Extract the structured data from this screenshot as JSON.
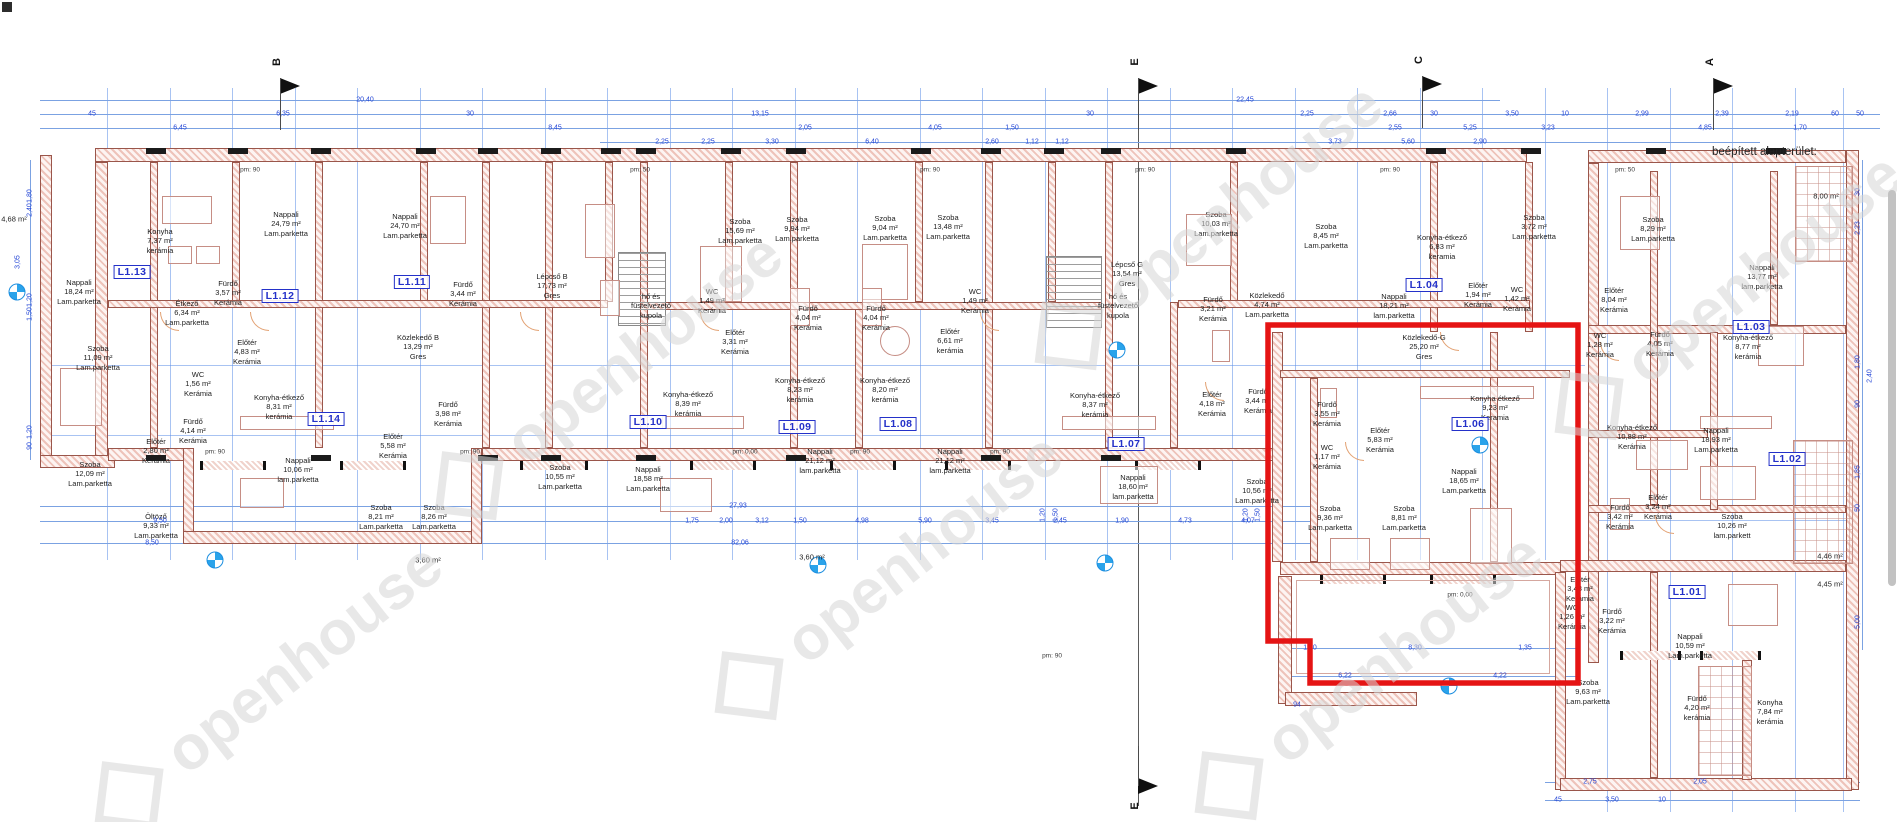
{
  "meta": {
    "area_note": "beépített alapterület:"
  },
  "watermark": {
    "text": "openhouse"
  },
  "highlight": {
    "color": "#e51414"
  },
  "colors": {
    "dim_blue": "#2446d6",
    "unit_blue": "#2431c9",
    "wall_hatch": "#9a564b"
  },
  "section_markers": [
    {
      "label": "B",
      "x": 280,
      "y": 72,
      "dir": "down"
    },
    {
      "label": "E",
      "x": 1138,
      "y": 72,
      "dir": "down"
    },
    {
      "label": "C",
      "x": 1422,
      "y": 70,
      "dir": "down"
    },
    {
      "label": "A",
      "x": 1713,
      "y": 72,
      "dir": "down"
    },
    {
      "label": "E",
      "x": 1138,
      "y": 786,
      "dir": "up"
    }
  ],
  "units": [
    {
      "t": "L1.13",
      "x": 132,
      "y": 272
    },
    {
      "t": "L1.12",
      "x": 280,
      "y": 296
    },
    {
      "t": "L1.11",
      "x": 412,
      "y": 282
    },
    {
      "t": "L1.14",
      "x": 326,
      "y": 419
    },
    {
      "t": "L1.10",
      "x": 648,
      "y": 422
    },
    {
      "t": "L1.09",
      "x": 797,
      "y": 427
    },
    {
      "t": "L1.08",
      "x": 898,
      "y": 424
    },
    {
      "t": "L1.07",
      "x": 1126,
      "y": 444
    },
    {
      "t": "L1.06",
      "x": 1470,
      "y": 424
    },
    {
      "t": "L1.04",
      "x": 1424,
      "y": 285
    },
    {
      "t": "L1.03",
      "x": 1751,
      "y": 327
    },
    {
      "t": "L1.02",
      "x": 1787,
      "y": 459
    },
    {
      "t": "L1.01",
      "x": 1687,
      "y": 592
    }
  ],
  "rooms": [
    {
      "l": [
        "Nappali",
        "18,24 m²",
        "Lam.parketta"
      ],
      "x": 79,
      "y": 292
    },
    {
      "l": [
        "Konyha",
        "7,37 m²",
        "kerámia"
      ],
      "x": 160,
      "y": 241
    },
    {
      "l": [
        "Nappali",
        "24,79 m²",
        "Lam.parketta"
      ],
      "x": 286,
      "y": 224
    },
    {
      "l": [
        "Fürdő",
        "3,57 m²",
        "Kerámia"
      ],
      "x": 228,
      "y": 293
    },
    {
      "l": [
        "Nappali",
        "24,70 m²",
        "Lam.parketta"
      ],
      "x": 405,
      "y": 226
    },
    {
      "l": [
        "Fürdő",
        "3,44 m²",
        "Kerámia"
      ],
      "x": 463,
      "y": 294
    },
    {
      "l": [
        "Szoba",
        "11,09 m²",
        "Lam.parketta"
      ],
      "x": 98,
      "y": 358
    },
    {
      "l": [
        "Étkező",
        "6,34 m²",
        "Lam.parketta"
      ],
      "x": 187,
      "y": 313
    },
    {
      "l": [
        "Előtér",
        "4,83 m²",
        "Kerámia"
      ],
      "x": 247,
      "y": 352
    },
    {
      "l": [
        "WC",
        "1,56 m²",
        "Kerámia"
      ],
      "x": 198,
      "y": 384
    },
    {
      "l": [
        "Fürdő",
        "4,14 m²",
        "Kerámia"
      ],
      "x": 193,
      "y": 431
    },
    {
      "l": [
        "Előtér",
        "2,80 m²",
        "Kerámia"
      ],
      "x": 156,
      "y": 451
    },
    {
      "l": [
        "Szoba",
        "12,09 m²",
        "Lam.parketta"
      ],
      "x": 90,
      "y": 474
    },
    {
      "l": [
        "Öltöző",
        "9,33 m²",
        "Lam.parketta"
      ],
      "x": 156,
      "y": 526
    },
    {
      "l": [
        "Közlekedő B",
        "13,29 m²",
        "Gres"
      ],
      "x": 418,
      "y": 347
    },
    {
      "l": [
        "Konyha-étkező",
        "8,31 m²",
        "kerámia"
      ],
      "x": 279,
      "y": 407
    },
    {
      "l": [
        "Nappali",
        "10,06 m²",
        "lam.parketta"
      ],
      "x": 298,
      "y": 470
    },
    {
      "l": [
        "Előtér",
        "5,58 m²",
        "Kerámia"
      ],
      "x": 393,
      "y": 446
    },
    {
      "l": [
        "Szoba",
        "8,21 m²",
        "Lam.parketta"
      ],
      "x": 381,
      "y": 517
    },
    {
      "l": [
        "Szoba",
        "8,26 m²",
        "Lam.parketta"
      ],
      "x": 434,
      "y": 517
    },
    {
      "l": [
        "Fürdő",
        "3,98 m²",
        "Kerámia"
      ],
      "x": 448,
      "y": 414
    },
    {
      "l": [
        "Lépcső B",
        "17,73 m²",
        "Gres"
      ],
      "x": 552,
      "y": 286
    },
    {
      "l": [
        "hő és",
        "füstelvezető",
        "kupola"
      ],
      "x": 651,
      "y": 306
    },
    {
      "l": [
        "Szoba",
        "10,55 m²",
        "Lam.parketta"
      ],
      "x": 560,
      "y": 477
    },
    {
      "l": [
        "Nappali",
        "18,58 m²",
        "Lam.parketta"
      ],
      "x": 648,
      "y": 479
    },
    {
      "l": [
        "Szoba",
        "15,69 m²",
        "Lam.parketta"
      ],
      "x": 740,
      "y": 231
    },
    {
      "l": [
        "Szoba",
        "9,94 m²",
        "Lam.parketta"
      ],
      "x": 797,
      "y": 229
    },
    {
      "l": [
        "WC",
        "1,49 m²",
        "Kerámia"
      ],
      "x": 712,
      "y": 301
    },
    {
      "l": [
        "Fürdő",
        "4,04 m²",
        "Kerámia"
      ],
      "x": 808,
      "y": 318
    },
    {
      "l": [
        "Előtér",
        "3,31 m²",
        "Kerámia"
      ],
      "x": 735,
      "y": 342
    },
    {
      "l": [
        "Konyha-étkező",
        "8,39 m²",
        "kerámia"
      ],
      "x": 688,
      "y": 404
    },
    {
      "l": [
        "Nappali",
        "21,12 m²",
        "lam.parketta"
      ],
      "x": 820,
      "y": 461
    },
    {
      "l": [
        "Szoba",
        "9,04 m²",
        "Lam.parketta"
      ],
      "x": 885,
      "y": 228
    },
    {
      "l": [
        "Szoba",
        "13,48 m²",
        "Lam.parketta"
      ],
      "x": 948,
      "y": 227
    },
    {
      "l": [
        "Fürdő",
        "4,04 m²",
        "Kerámia"
      ],
      "x": 876,
      "y": 318
    },
    {
      "l": [
        "WC",
        "1,49 m²",
        "Kerámia"
      ],
      "x": 975,
      "y": 301
    },
    {
      "l": [
        "Előtér",
        "6,61 m²",
        "kerámia"
      ],
      "x": 950,
      "y": 341
    },
    {
      "l": [
        "Konyha-étkező",
        "8,23 m²",
        "kerámia"
      ],
      "x": 800,
      "y": 390
    },
    {
      "l": [
        "Konyha-étkező",
        "8,20 m²",
        "kerámia"
      ],
      "x": 885,
      "y": 390
    },
    {
      "l": [
        "Nappali",
        "21,12 m²",
        "lam.parketta"
      ],
      "x": 950,
      "y": 461
    },
    {
      "l": [
        "Konyha-étkező",
        "8,37 m²",
        "kerámia"
      ],
      "x": 1095,
      "y": 405
    },
    {
      "l": [
        "Nappali",
        "18,60 m²",
        "lam.parketta"
      ],
      "x": 1133,
      "y": 487
    },
    {
      "l": [
        "Előtér",
        "4,18 m²",
        "Kerámia"
      ],
      "x": 1212,
      "y": 404
    },
    {
      "l": [
        "Szoba",
        "10,56 m²",
        "Lam.parketta"
      ],
      "x": 1257,
      "y": 491
    },
    {
      "l": [
        "Lépcső G",
        "13,54 m²",
        "Gres"
      ],
      "x": 1127,
      "y": 274
    },
    {
      "l": [
        "hő és",
        "füstelvezető",
        "kupola"
      ],
      "x": 1118,
      "y": 306
    },
    {
      "l": [
        "Fürdő",
        "3,21 m²",
        "Kerámia"
      ],
      "x": 1213,
      "y": 309
    },
    {
      "l": [
        "Közlekedő",
        "4,74 m²",
        "Lam.parketta"
      ],
      "x": 1267,
      "y": 305
    },
    {
      "l": [
        "Szoba",
        "10,03 m²",
        "Lam.parketta"
      ],
      "x": 1216,
      "y": 224
    },
    {
      "l": [
        "Szoba",
        "8,45 m²",
        "Lam.parketta"
      ],
      "x": 1326,
      "y": 236
    },
    {
      "l": [
        "Fürdő",
        "3,44 m²",
        "Kerámia"
      ],
      "x": 1258,
      "y": 401
    },
    {
      "l": [
        "Nappali",
        "18,21 m²",
        "lam.parketta"
      ],
      "x": 1394,
      "y": 306
    },
    {
      "l": [
        "Konyha-étkező",
        "6,83 m²",
        "keramia"
      ],
      "x": 1442,
      "y": 247
    },
    {
      "l": [
        "Előtér",
        "1,94 m²",
        "Kerámia"
      ],
      "x": 1478,
      "y": 295
    },
    {
      "l": [
        "WC",
        "1,42 m²",
        "Kerámia"
      ],
      "x": 1517,
      "y": 299
    },
    {
      "l": [
        "Szoba",
        "3,72 m²",
        "Lam.parketta"
      ],
      "x": 1534,
      "y": 227
    },
    {
      "l": [
        "Szoba",
        "8,29 m²",
        "Lam.parketta"
      ],
      "x": 1653,
      "y": 229
    },
    {
      "l": [
        "Közlekedő-G",
        "25,20 m²",
        "Gres"
      ],
      "x": 1424,
      "y": 347
    },
    {
      "l": [
        "Konyha étkező",
        "9,23 m²",
        "Keramia"
      ],
      "x": 1495,
      "y": 408
    },
    {
      "l": [
        "Nappali",
        "18,65 m²",
        "Lam.parketta"
      ],
      "x": 1464,
      "y": 481
    },
    {
      "l": [
        "Előtér",
        "5,83 m²",
        "Kerámia"
      ],
      "x": 1380,
      "y": 440
    },
    {
      "l": [
        "Fürdő",
        "3,55 m²",
        "Kerámia"
      ],
      "x": 1327,
      "y": 414
    },
    {
      "l": [
        "WC",
        "1,17 m²",
        "Kerámia"
      ],
      "x": 1327,
      "y": 457
    },
    {
      "l": [
        "Szoba",
        "9,36 m²",
        "Lam.parketta"
      ],
      "x": 1330,
      "y": 518
    },
    {
      "l": [
        "Szoba",
        "8,81 m²",
        "Lam.parketta"
      ],
      "x": 1404,
      "y": 518
    },
    {
      "l": [
        "Előtér",
        "8,04 m²",
        "Kerámia"
      ],
      "x": 1614,
      "y": 300
    },
    {
      "l": [
        "WC",
        "1,28 m²",
        "Kerámia"
      ],
      "x": 1600,
      "y": 345
    },
    {
      "l": [
        "Fürdő",
        "4,05 m²",
        "Kerámia"
      ],
      "x": 1660,
      "y": 344
    },
    {
      "l": [
        "Nappali",
        "13,77 m²",
        "lam.parketta"
      ],
      "x": 1762,
      "y": 277
    },
    {
      "l": [
        "Konyha-étkező",
        "8,77 m²",
        "kerámia"
      ],
      "x": 1748,
      "y": 347
    },
    {
      "l": [
        "Nappali",
        "18,93 m²",
        "Lam.parketta"
      ],
      "x": 1716,
      "y": 440
    },
    {
      "l": [
        "Konyha-étkező",
        "10,88 m²",
        "Kerámia"
      ],
      "x": 1632,
      "y": 437
    },
    {
      "l": [
        "Szoba",
        "10,26 m²",
        "lam.parkett"
      ],
      "x": 1732,
      "y": 526
    },
    {
      "l": [
        "Előtér",
        "3,24 m²",
        "Kerámia"
      ],
      "x": 1658,
      "y": 507
    },
    {
      "l": [
        "Fürdő",
        "3,42 m²",
        "Kerámia"
      ],
      "x": 1620,
      "y": 517
    },
    {
      "l": [
        "Előtér",
        "3,48 m²",
        "Kerámia"
      ],
      "x": 1580,
      "y": 589
    },
    {
      "l": [
        "WC",
        "1,26 m²",
        "Kerámia"
      ],
      "x": 1572,
      "y": 617
    },
    {
      "l": [
        "Fürdő",
        "3,22 m²",
        "Kerámia"
      ],
      "x": 1612,
      "y": 621
    },
    {
      "l": [
        "Nappali",
        "10,59 m²",
        "Lam.parketta"
      ],
      "x": 1690,
      "y": 646
    },
    {
      "l": [
        "Szoba",
        "9,63 m²",
        "Lam.parketta"
      ],
      "x": 1588,
      "y": 692
    },
    {
      "l": [
        "Fürdő",
        "4,20 m²",
        "kerámia"
      ],
      "x": 1697,
      "y": 708
    },
    {
      "l": [
        "Konyha",
        "7,84 m²",
        "kerámia"
      ],
      "x": 1770,
      "y": 712
    },
    {
      "l": [
        "4,68 m²"
      ],
      "x": 14,
      "y": 219
    },
    {
      "l": [
        "8,00 m²"
      ],
      "x": 1826,
      "y": 196
    },
    {
      "l": [
        "4,46 m²"
      ],
      "x": 1830,
      "y": 556
    },
    {
      "l": [
        "4,45 m²"
      ],
      "x": 1830,
      "y": 584
    },
    {
      "l": [
        "3,60 m²"
      ],
      "x": 428,
      "y": 560
    },
    {
      "l": [
        "3,60 m²"
      ],
      "x": 812,
      "y": 557
    }
  ],
  "dims": [
    {
      "t": "20,40",
      "x": 365,
      "y": 100
    },
    {
      "t": "22,45",
      "x": 1245,
      "y": 100
    },
    {
      "t": "45",
      "x": 92,
      "y": 114
    },
    {
      "t": "6,35",
      "x": 283,
      "y": 114
    },
    {
      "t": "30",
      "x": 470,
      "y": 114
    },
    {
      "t": "13,15",
      "x": 760,
      "y": 114
    },
    {
      "t": "30",
      "x": 1090,
      "y": 114
    },
    {
      "t": "2,25",
      "x": 1307,
      "y": 114
    },
    {
      "t": "2,66",
      "x": 1390,
      "y": 114
    },
    {
      "t": "30",
      "x": 1434,
      "y": 114
    },
    {
      "t": "3,50",
      "x": 1512,
      "y": 114
    },
    {
      "t": "10",
      "x": 1565,
      "y": 114
    },
    {
      "t": "2,99",
      "x": 1642,
      "y": 114
    },
    {
      "t": "2,39",
      "x": 1722,
      "y": 114
    },
    {
      "t": "2,19",
      "x": 1792,
      "y": 114
    },
    {
      "t": "60",
      "x": 1835,
      "y": 114
    },
    {
      "t": "50",
      "x": 1860,
      "y": 114
    },
    {
      "t": "6,45",
      "x": 180,
      "y": 128
    },
    {
      "t": "8,45",
      "x": 555,
      "y": 128
    },
    {
      "t": "2,05",
      "x": 805,
      "y": 128
    },
    {
      "t": "4,05",
      "x": 935,
      "y": 128
    },
    {
      "t": "1,50",
      "x": 1012,
      "y": 128
    },
    {
      "t": "2,55",
      "x": 1395,
      "y": 128
    },
    {
      "t": "5,25",
      "x": 1470,
      "y": 128
    },
    {
      "t": "3,23",
      "x": 1548,
      "y": 128
    },
    {
      "t": "4,85",
      "x": 1705,
      "y": 128
    },
    {
      "t": "1,70",
      "x": 1800,
      "y": 128
    },
    {
      "t": "2,25",
      "x": 662,
      "y": 142
    },
    {
      "t": "2,25",
      "x": 708,
      "y": 142
    },
    {
      "t": "3,30",
      "x": 772,
      "y": 142
    },
    {
      "t": "6,40",
      "x": 872,
      "y": 142
    },
    {
      "t": "2,60",
      "x": 992,
      "y": 142
    },
    {
      "t": "1,12",
      "x": 1032,
      "y": 142
    },
    {
      "t": "1,12",
      "x": 1062,
      "y": 142
    },
    {
      "t": "3,73",
      "x": 1335,
      "y": 142
    },
    {
      "t": "5,60",
      "x": 1408,
      "y": 142
    },
    {
      "t": "2,90",
      "x": 1480,
      "y": 142
    },
    {
      "t": "27,93",
      "x": 738,
      "y": 506
    },
    {
      "t": "9,50",
      "x": 160,
      "y": 521
    },
    {
      "t": "1,75",
      "x": 692,
      "y": 521
    },
    {
      "t": "2,00",
      "x": 726,
      "y": 521
    },
    {
      "t": "3,12",
      "x": 762,
      "y": 521
    },
    {
      "t": "1,50",
      "x": 800,
      "y": 521
    },
    {
      "t": "4,98",
      "x": 862,
      "y": 521
    },
    {
      "t": "5,90",
      "x": 925,
      "y": 521
    },
    {
      "t": "3,45",
      "x": 992,
      "y": 521
    },
    {
      "t": "2,45",
      "x": 1060,
      "y": 521
    },
    {
      "t": "1,90",
      "x": 1122,
      "y": 521
    },
    {
      "t": "4,73",
      "x": 1185,
      "y": 521
    },
    {
      "t": "4,07",
      "x": 1248,
      "y": 521
    },
    {
      "t": "8,50",
      "x": 152,
      "y": 543
    },
    {
      "t": "82,06",
      "x": 740,
      "y": 543
    },
    {
      "t": "1,50",
      "x": 1310,
      "y": 648
    },
    {
      "t": "8,30",
      "x": 1415,
      "y": 648
    },
    {
      "t": "1,35",
      "x": 1525,
      "y": 648
    },
    {
      "t": "6,22",
      "x": 1345,
      "y": 676
    },
    {
      "t": "4,22",
      "x": 1500,
      "y": 676
    },
    {
      "t": "94",
      "x": 1297,
      "y": 705
    },
    {
      "t": "2,75",
      "x": 1590,
      "y": 782
    },
    {
      "t": "2,05",
      "x": 1700,
      "y": 782
    },
    {
      "t": "45",
      "x": 1558,
      "y": 800
    },
    {
      "t": "3,50",
      "x": 1612,
      "y": 800
    },
    {
      "t": "10",
      "x": 1662,
      "y": 800
    },
    {
      "t": "1,80",
      "x": 30,
      "y": 196,
      "r": 1
    },
    {
      "t": "2,40",
      "x": 30,
      "y": 210,
      "r": 1
    },
    {
      "t": "1,20",
      "x": 30,
      "y": 300,
      "r": 1
    },
    {
      "t": "1,50",
      "x": 30,
      "y": 314,
      "r": 1
    },
    {
      "t": "1,20",
      "x": 30,
      "y": 432,
      "r": 1
    },
    {
      "t": "90",
      "x": 30,
      "y": 446,
      "r": 1
    },
    {
      "t": "3,05",
      "x": 18,
      "y": 262,
      "r": 1
    },
    {
      "t": "30",
      "x": 1858,
      "y": 192,
      "r": 1
    },
    {
      "t": "2,23",
      "x": 1858,
      "y": 228,
      "r": 1
    },
    {
      "t": "1,80",
      "x": 1858,
      "y": 362,
      "r": 1
    },
    {
      "t": "2,40",
      "x": 1870,
      "y": 376,
      "r": 1
    },
    {
      "t": "90",
      "x": 1858,
      "y": 404,
      "r": 1
    },
    {
      "t": "1,85",
      "x": 1858,
      "y": 472,
      "r": 1
    },
    {
      "t": "50",
      "x": 1858,
      "y": 508,
      "r": 1
    },
    {
      "t": "5,00",
      "x": 1858,
      "y": 622,
      "r": 1
    },
    {
      "t": "1,20",
      "x": 1043,
      "y": 515,
      "r": 1
    },
    {
      "t": "1,50",
      "x": 1056,
      "y": 515,
      "r": 1
    },
    {
      "t": "1,20",
      "x": 1246,
      "y": 515,
      "r": 1
    },
    {
      "t": "1,50",
      "x": 1258,
      "y": 515,
      "r": 1
    }
  ],
  "wall_notes": [
    {
      "t": "pm: 90",
      "x": 215,
      "y": 452
    },
    {
      "t": "pm: 90",
      "x": 470,
      "y": 452
    },
    {
      "t": "pm: 0,00",
      "x": 745,
      "y": 452
    },
    {
      "t": "pm: 90",
      "x": 860,
      "y": 452
    },
    {
      "t": "pm: 90",
      "x": 1000,
      "y": 452
    },
    {
      "t": "pm: 90",
      "x": 250,
      "y": 170
    },
    {
      "t": "pm: 50",
      "x": 640,
      "y": 170
    },
    {
      "t": "pm: 90",
      "x": 930,
      "y": 170
    },
    {
      "t": "pm: 90",
      "x": 1145,
      "y": 170
    },
    {
      "t": "pm: 90",
      "x": 1390,
      "y": 170
    },
    {
      "t": "pm: 50",
      "x": 1625,
      "y": 170
    },
    {
      "t": "pm: 90",
      "x": 1052,
      "y": 656
    },
    {
      "t": "pm: 0,00",
      "x": 1460,
      "y": 595
    }
  ]
}
